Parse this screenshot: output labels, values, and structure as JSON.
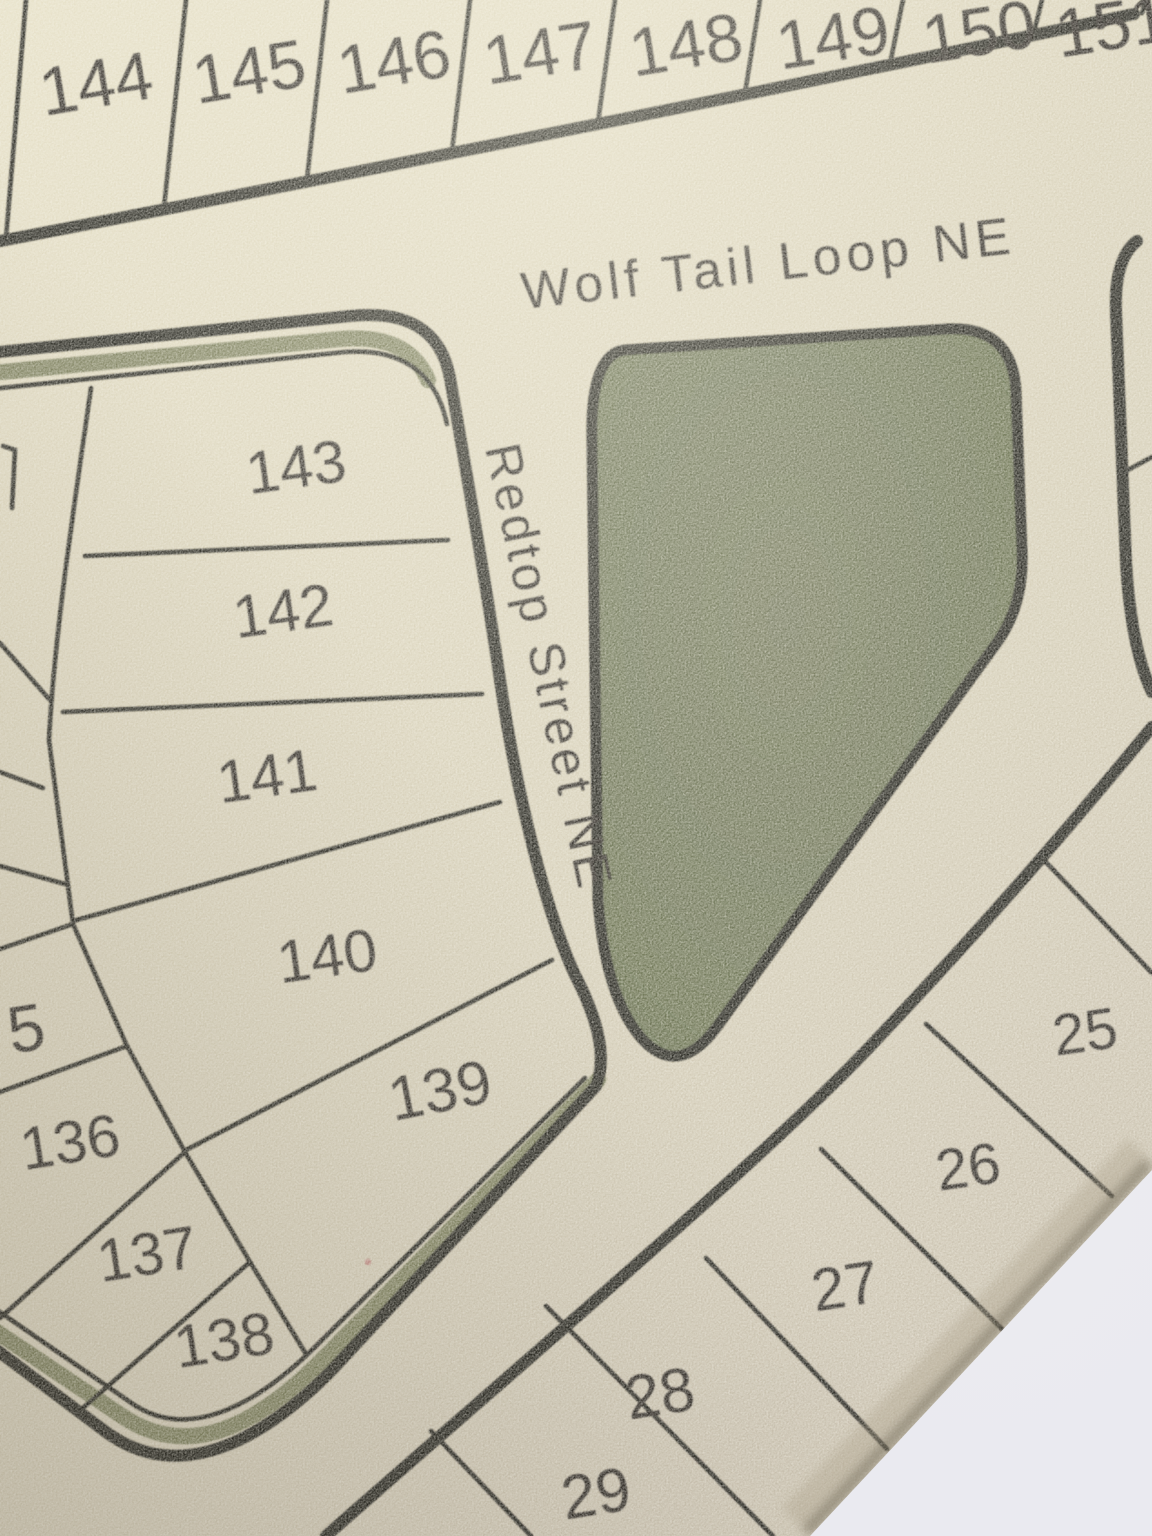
{
  "map": {
    "street_labels": {
      "wolf_tail_loop": "Wolf Tail Loop NE",
      "redtop_street": "Redtop Street NE"
    },
    "lot_numbers": {
      "top_row": [
        "144",
        "145",
        "146",
        "147",
        "148",
        "149",
        "150",
        "151"
      ],
      "west_block": [
        "143",
        "142",
        "141",
        "140",
        "139"
      ],
      "southwest_block": [
        "5",
        "136",
        "137",
        "138"
      ],
      "southeast_block": [
        "25",
        "26",
        "27",
        "28",
        "29"
      ]
    },
    "colors": {
      "paper_tan": "#d9d2ba",
      "park_green": "#6b7052",
      "strip_green": "#7b7f5d",
      "ink_line": "#24211b",
      "ink_text": "#2b2823",
      "page_white": "#eaeaf0"
    }
  }
}
